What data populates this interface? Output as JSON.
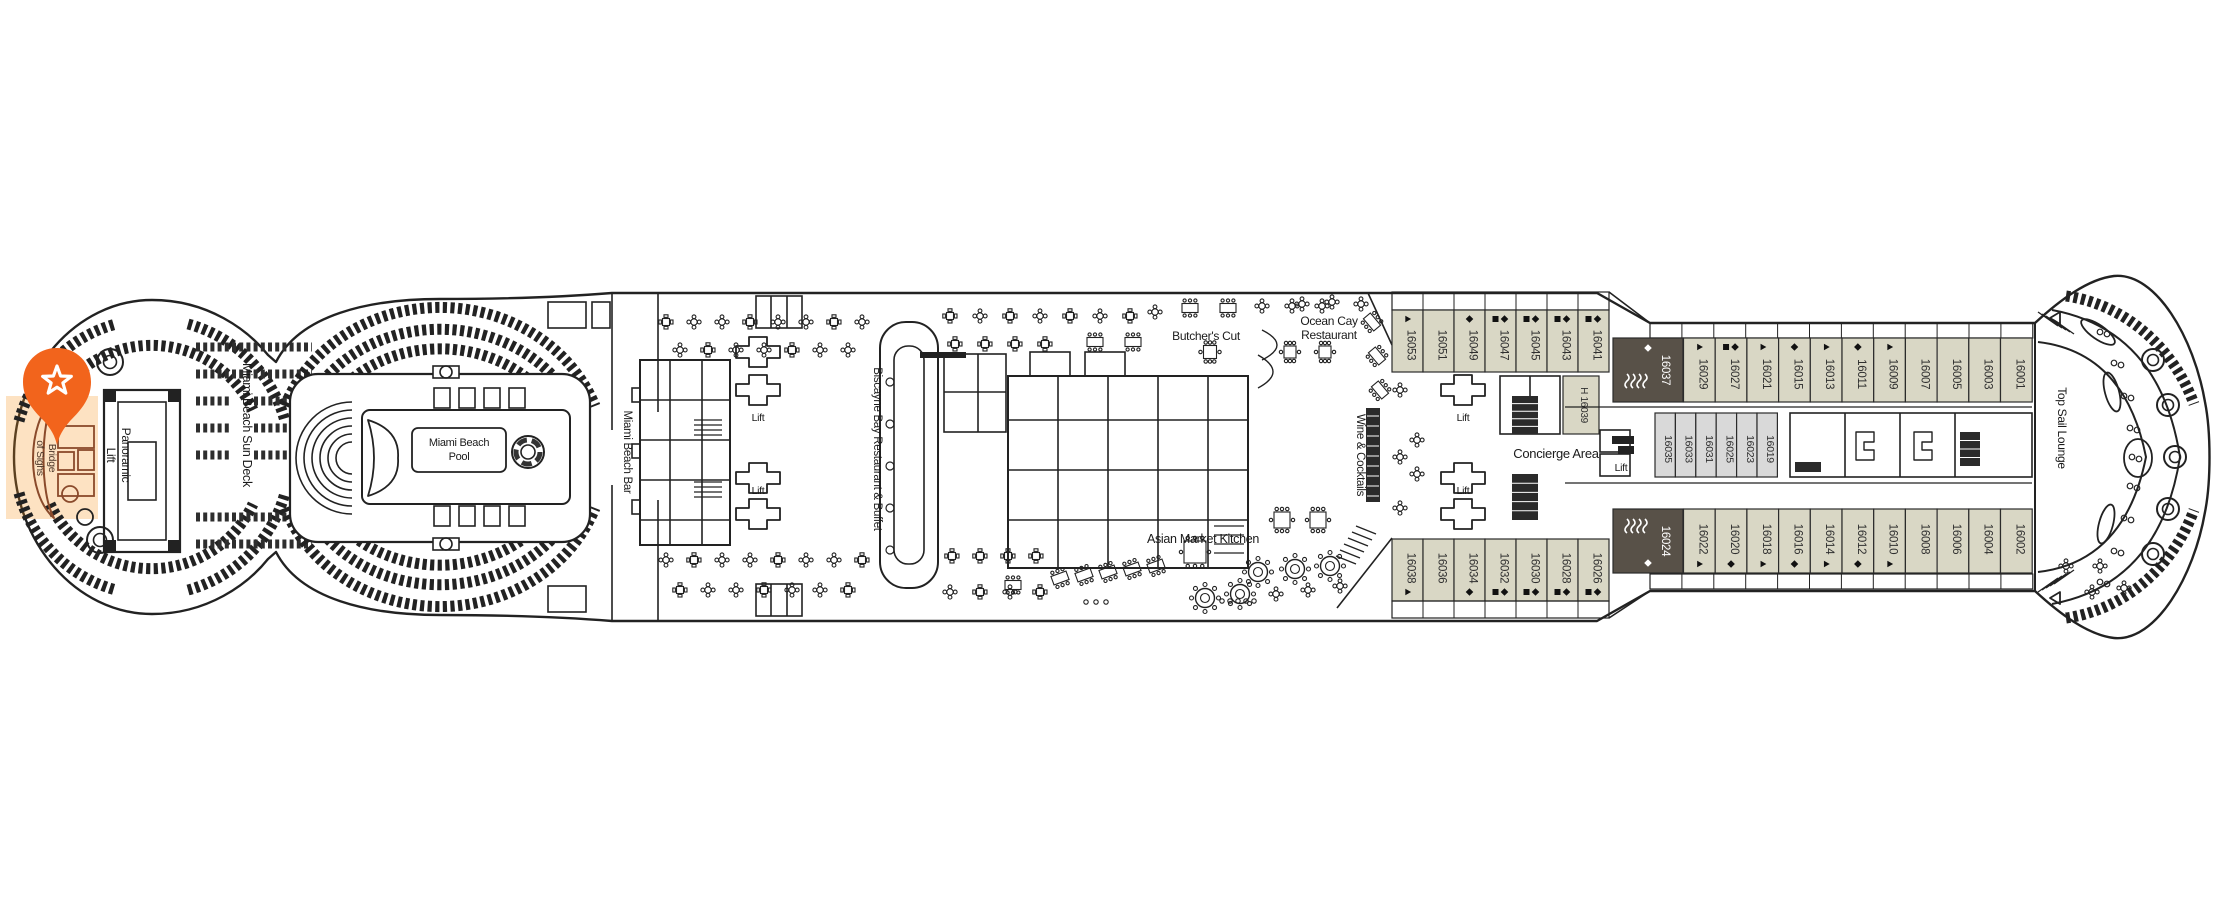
{
  "deck_plan": {
    "marker": {
      "icon": "star",
      "color": "#F2641C"
    },
    "areas": {
      "bridge_of_sighs": {
        "label": "Bridge of Sighs",
        "lines": [
          "Bridge",
          "of Sighs"
        ]
      },
      "panoramic_lift": {
        "label": "Panoramic Lift",
        "lines": [
          "Panoramic",
          "Lift"
        ]
      },
      "miami_beach_sun_deck": {
        "label": "Miami Beach Sun Deck"
      },
      "miami_beach_pool": {
        "label": "Miami Beach Pool",
        "lines": [
          "Miami Beach",
          "Pool"
        ]
      },
      "miami_beach_bar": {
        "label": "Miami Beach Bar"
      },
      "biscayne_bay": {
        "label": "Biscayne Bay Restaurant & Buffet"
      },
      "butchers_cut": {
        "label": "Butcher's Cut"
      },
      "ocean_cay": {
        "label": "Ocean Cay Restaurant",
        "lines": [
          "Ocean Cay",
          "Restaurant"
        ]
      },
      "wine_and_cocktails": {
        "label": "Wine & Cocktails"
      },
      "asian_market_kitchen": {
        "label": "Asian Market Kitchen"
      },
      "concierge_area": {
        "label": "Concierge Area"
      },
      "top_sail_lounge": {
        "label": "Top Sail Lounge"
      },
      "lift": {
        "label": "Lift"
      }
    },
    "accessible_cabin": {
      "prefix": "H",
      "num": "16039",
      "label": "H 16039"
    },
    "cabin_rows": {
      "top_outer_forward": [
        {
          "num": "16053",
          "sym": "triangle"
        },
        {
          "num": "16051",
          "sym": null
        },
        {
          "num": "16049",
          "sym": "diamond"
        },
        {
          "num": "16047",
          "sym": "square-diamond"
        },
        {
          "num": "16045",
          "sym": "square-diamond"
        },
        {
          "num": "16043",
          "sym": "square-diamond"
        },
        {
          "num": "16041",
          "sym": "square-diamond"
        }
      ],
      "suite_top": {
        "num": "16037",
        "sym": "diamond",
        "waves": true
      },
      "top_outer_aft": [
        {
          "num": "16029",
          "sym": "triangle"
        },
        {
          "num": "16027",
          "sym": "square-diamond"
        },
        {
          "num": "16021",
          "sym": "triangle"
        },
        {
          "num": "16015",
          "sym": "diamond"
        },
        {
          "num": "16013",
          "sym": "triangle"
        },
        {
          "num": "16011",
          "sym": "diamond"
        },
        {
          "num": "16009",
          "sym": "triangle"
        },
        {
          "num": "16007",
          "sym": null
        },
        {
          "num": "16005",
          "sym": null
        },
        {
          "num": "16003",
          "sym": null
        },
        {
          "num": "16001",
          "sym": null
        }
      ],
      "inner": [
        {
          "num": "16035",
          "sym": null
        },
        {
          "num": "16033",
          "sym": null
        },
        {
          "num": "16031",
          "sym": null
        },
        {
          "num": "16025",
          "sym": null
        },
        {
          "num": "16023",
          "sym": null
        },
        {
          "num": "16019",
          "sym": null
        }
      ],
      "bottom_outer_forward": [
        {
          "num": "16038",
          "sym": "triangle"
        },
        {
          "num": "16036",
          "sym": null
        },
        {
          "num": "16034",
          "sym": "diamond"
        },
        {
          "num": "16032",
          "sym": "square-diamond"
        },
        {
          "num": "16030",
          "sym": "square-diamond"
        },
        {
          "num": "16028",
          "sym": "square-diamond"
        },
        {
          "num": "16026",
          "sym": "square-diamond"
        }
      ],
      "suite_bottom": {
        "num": "16024",
        "sym": "diamond",
        "waves": true
      },
      "bottom_outer_aft": [
        {
          "num": "16022",
          "sym": "triangle"
        },
        {
          "num": "16020",
          "sym": "diamond"
        },
        {
          "num": "16018",
          "sym": "triangle"
        },
        {
          "num": "16016",
          "sym": "diamond"
        },
        {
          "num": "16014",
          "sym": "triangle"
        },
        {
          "num": "16012",
          "sym": "diamond"
        },
        {
          "num": "16010",
          "sym": "triangle"
        },
        {
          "num": "16008",
          "sym": null
        },
        {
          "num": "16006",
          "sym": null
        },
        {
          "num": "16004",
          "sym": null
        },
        {
          "num": "16002",
          "sym": null
        }
      ]
    },
    "colors": {
      "line": "#222222",
      "cabin_balcony": "#d9d7c5",
      "cabin_suite": "#585148",
      "cabin_inner": "#d9d9d9",
      "accent_orange": "#F2641C",
      "highlight": "#F7941E",
      "highlight_line": "#8a4a2b"
    }
  }
}
